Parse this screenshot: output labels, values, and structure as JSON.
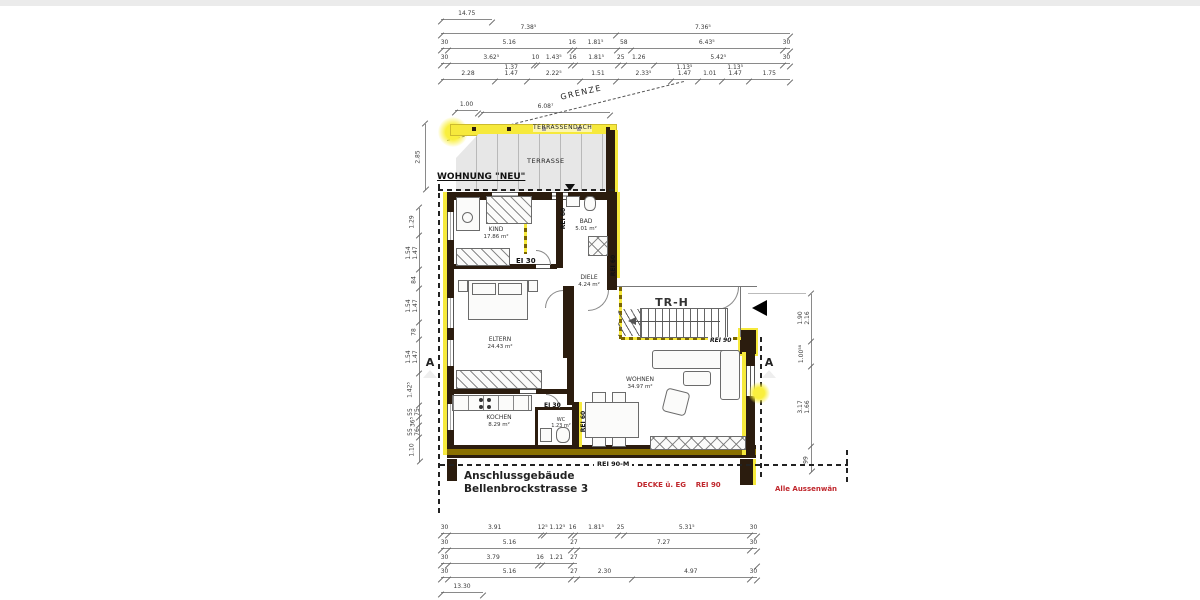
{
  "colors": {
    "highlight": "#f6e93c",
    "wall": "#2b1c0e",
    "olive": "#8a7000",
    "red": "#c0272d"
  },
  "labels": {
    "grenze": "GRENZE",
    "wohnung": "WOHNUNG \"NEU\"",
    "terrassendach": "TERRASSENDACH",
    "terrasse": "TERRASSE",
    "trh": "TR-H",
    "ei30": "EI 30",
    "rei60": "REI 60",
    "rei90": "REI 90",
    "rei90m": "REI 90-M",
    "building_line1": "Anschlussgebäude",
    "building_line2": "Bellenbrockstrasse 3",
    "decke": "DECKE ü. EG    REI 90",
    "aussen": "Alle Aussenwän",
    "section": "A"
  },
  "rooms": [
    {
      "name": "KIND",
      "area": "17.86 m²"
    },
    {
      "name": "BAD",
      "area": "5.01 m²"
    },
    {
      "name": "DIELE",
      "area": "4.24 m²"
    },
    {
      "name": "ELTERN",
      "area": "24.43 m²"
    },
    {
      "name": "KOCHEN",
      "area": "8.29 m²"
    },
    {
      "name": "WC",
      "area": "1.23 m²"
    },
    {
      "name": "WOHNEN",
      "area": "34.97 m²"
    },
    {
      "name": "TR-H",
      "area": ""
    }
  ],
  "dims": {
    "top1": [
      "14.75"
    ],
    "top2": [
      "7.38⁵",
      "7.36⁵"
    ],
    "top3": [
      "30",
      "5.16",
      "16",
      "1.81⁵",
      "58",
      "6.43⁵",
      "30"
    ],
    "top4": [
      "30",
      "3.62⁵",
      "10",
      "1.43⁵",
      "16",
      "1.81⁵",
      "25",
      "1.26",
      "5.42⁵",
      "30"
    ],
    "top5": [
      "2.28",
      "1.37\n1.47",
      "2.22⁵",
      "1.51",
      "2.33⁵",
      "1.13⁵\n1.47",
      "1.01",
      "1.13⁵\n1.47",
      "1.75"
    ],
    "bottom1": [
      "30",
      "3.91",
      "12⁵",
      "1.12⁵",
      "16",
      "1.81⁵",
      "25",
      "5.31⁵",
      "30"
    ],
    "bottom2": [
      "30",
      "5.16",
      "27",
      "7.27",
      "30"
    ],
    "bottom3": [
      "30",
      "3.79",
      "16",
      "1.21",
      "27",
      "!7.57"
    ],
    "bottom4": [
      "30",
      "5.16",
      "27",
      "2.30",
      "4.97",
      "30"
    ],
    "bottom5": [
      "13.30"
    ],
    "terr1": [
      "1.00"
    ],
    "terr2": [
      "6.08⁷"
    ],
    "left1": [
      "2.85"
    ],
    "left2": [
      "1.29",
      "1.54\n1.47",
      "84",
      "1.54\n1.47",
      "78",
      "1.54\n1.47",
      "1.42⁵",
      "55\n75",
      "36⁵",
      "55\n76",
      "1.10"
    ],
    "right1": [
      "!6.55",
      "1.90\n2.16",
      "1.00⁵⁸",
      "3.17\n1.66",
      "99"
    ]
  }
}
